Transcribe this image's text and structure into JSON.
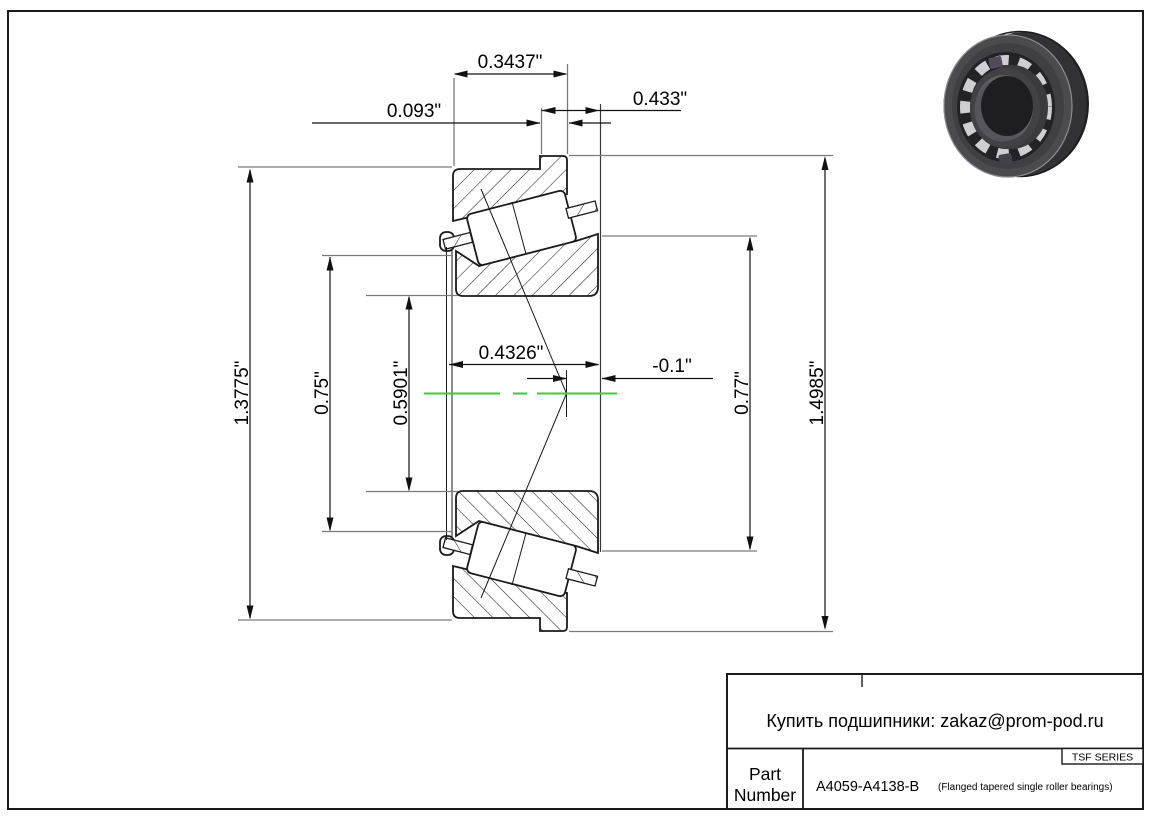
{
  "dims": {
    "top": {
      "cup_width": "0.3437\"",
      "flange_width": "0.093\"",
      "total_width": "0.433\""
    },
    "middle": {
      "cone_width": "0.4326\"",
      "flange_offset": "-0.1\""
    },
    "left": {
      "cup_od": "1.3775\"",
      "front_od": "0.75\"",
      "bore": "0.5901\""
    },
    "right": {
      "rib_od": "0.77\"",
      "flange_od": "1.4985\""
    }
  },
  "title_block": {
    "contact": "Купить подшипники: zakaz@prom-pod.ru",
    "series": "TSF SERIES",
    "part_label_line1": "Part",
    "part_label_line2": "Number",
    "part_number": "A4059-A4138-B",
    "part_description": "(Flanged tapered single roller bearings)"
  },
  "colors": {
    "centerline": "#3bcb3b",
    "line": "#1a1a1a"
  }
}
